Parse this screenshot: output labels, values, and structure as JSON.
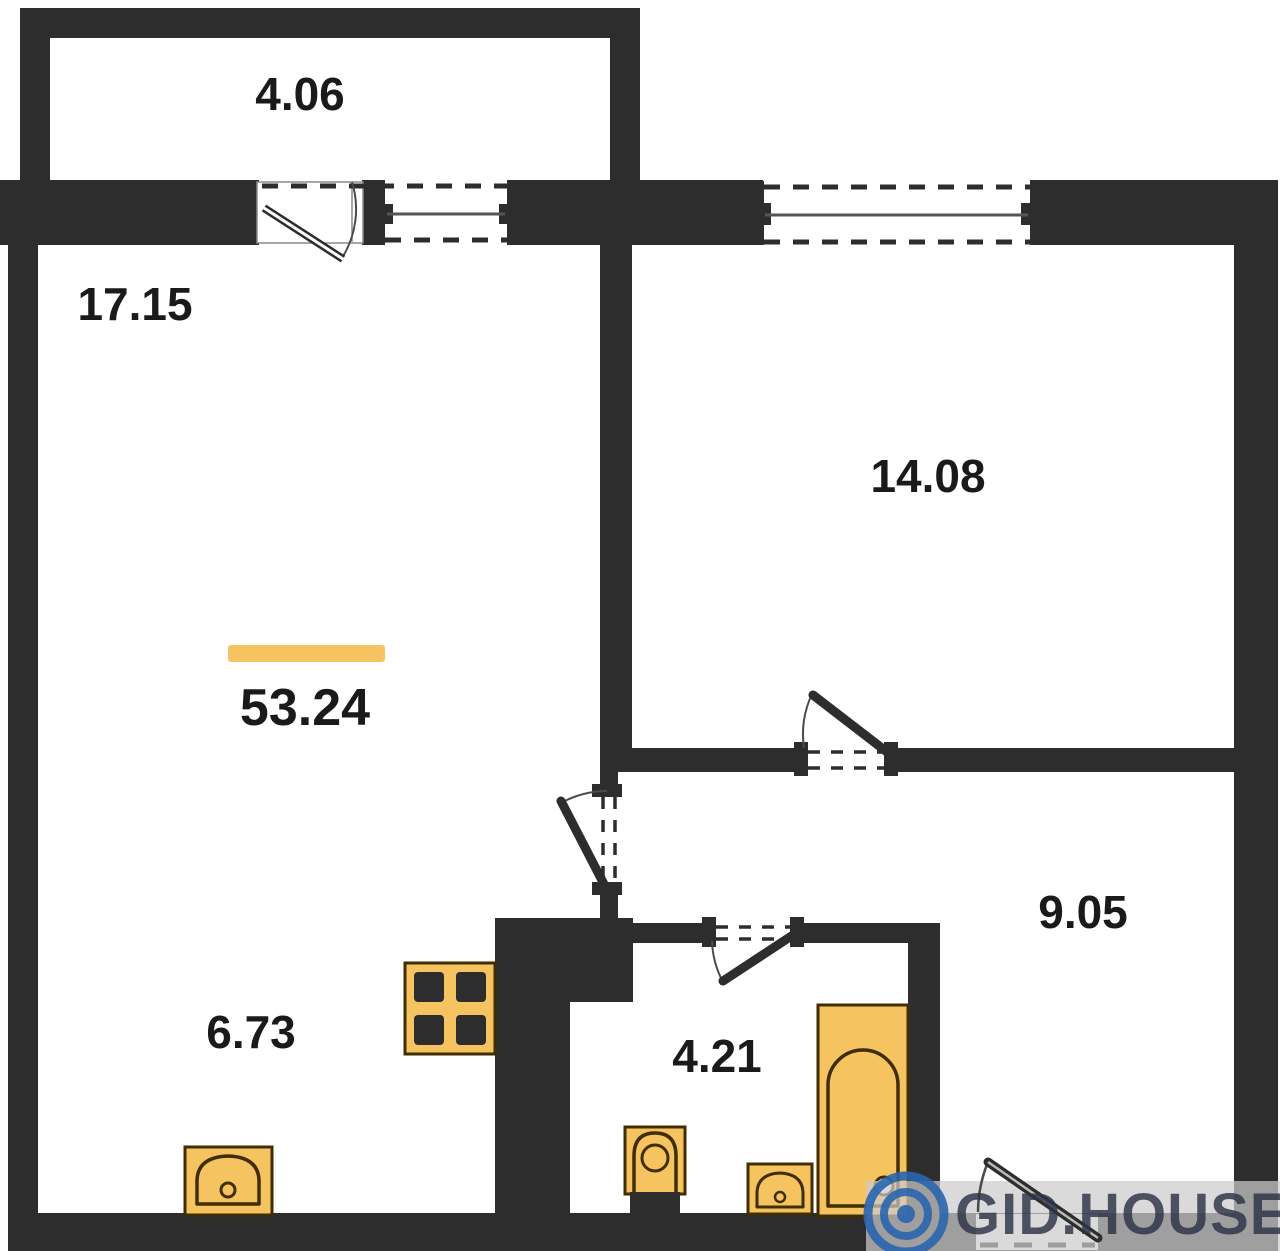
{
  "plan": {
    "type": "apartment-floor-plan",
    "total_area": "53.24",
    "rooms": {
      "balcony": {
        "area": "4.06"
      },
      "living_room": {
        "area": "17.15"
      },
      "bedroom": {
        "area": "14.08"
      },
      "hallway": {
        "area": "9.05"
      },
      "kitchen": {
        "area": "6.73"
      },
      "bathroom": {
        "area": "4.21"
      }
    },
    "fixtures": [
      "stove-icon",
      "kitchen-sink-icon",
      "toilet-icon",
      "bathroom-sink-icon",
      "bathtub-icon"
    ],
    "colors": {
      "wall": "#2d2d2d",
      "fixture_fill": "#f6c361",
      "fixture_outline": "#402e00",
      "accent_bar": "#f7c260",
      "label_text": "#1a1a1a",
      "door_arc": "#4a4a4a",
      "window_line": "#555555",
      "watermark_band": "#cccccc",
      "watermark_text": "#2d3348",
      "watermark_logo": "#2a66ae"
    }
  },
  "watermark": {
    "text": "GID.HOUSE",
    "logo": "copyright-icon"
  }
}
